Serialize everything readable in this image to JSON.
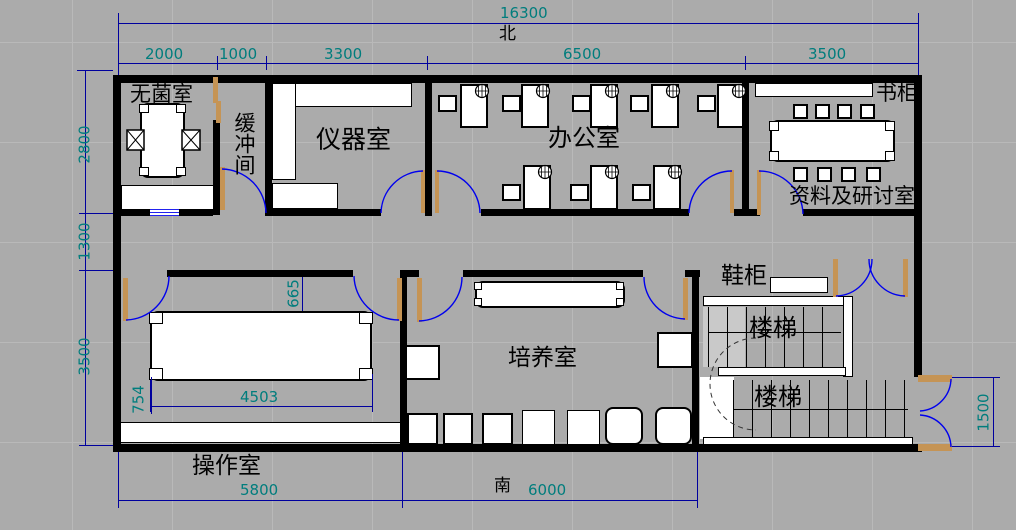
{
  "drawing": {
    "compass": {
      "north": "北",
      "south": "南"
    },
    "rooms": {
      "sterile": "无菌室",
      "buffer": "缓冲间",
      "instrument": "仪器室",
      "office": "办公室",
      "bookcase": "书柜",
      "seminar": "资料及研讨室",
      "shoe_cabinet": "鞋柜",
      "stairs_upper": "楼梯",
      "stairs_lower": "楼梯",
      "culture": "培养室",
      "operation": "操作室"
    },
    "dims": {
      "total_width": "16300",
      "top_segments": [
        "2000",
        "1000",
        "3300",
        "6500",
        "3500"
      ],
      "left_segments": [
        "2800",
        "1300",
        "3500"
      ],
      "bottom_segments": [
        "5800",
        "6000"
      ],
      "entry_door": "1500",
      "op_table_width": "4503",
      "op_table_offset": "754",
      "op_door_offset": "665"
    },
    "colors": {
      "canvas": "#ababab",
      "wall": "#000000",
      "dim_line": "#00009e",
      "dim_text": "#007d7d",
      "door_arc": "#0000ee",
      "door_leaf": "#c59455",
      "furniture_fill": "#ffffff"
    }
  }
}
